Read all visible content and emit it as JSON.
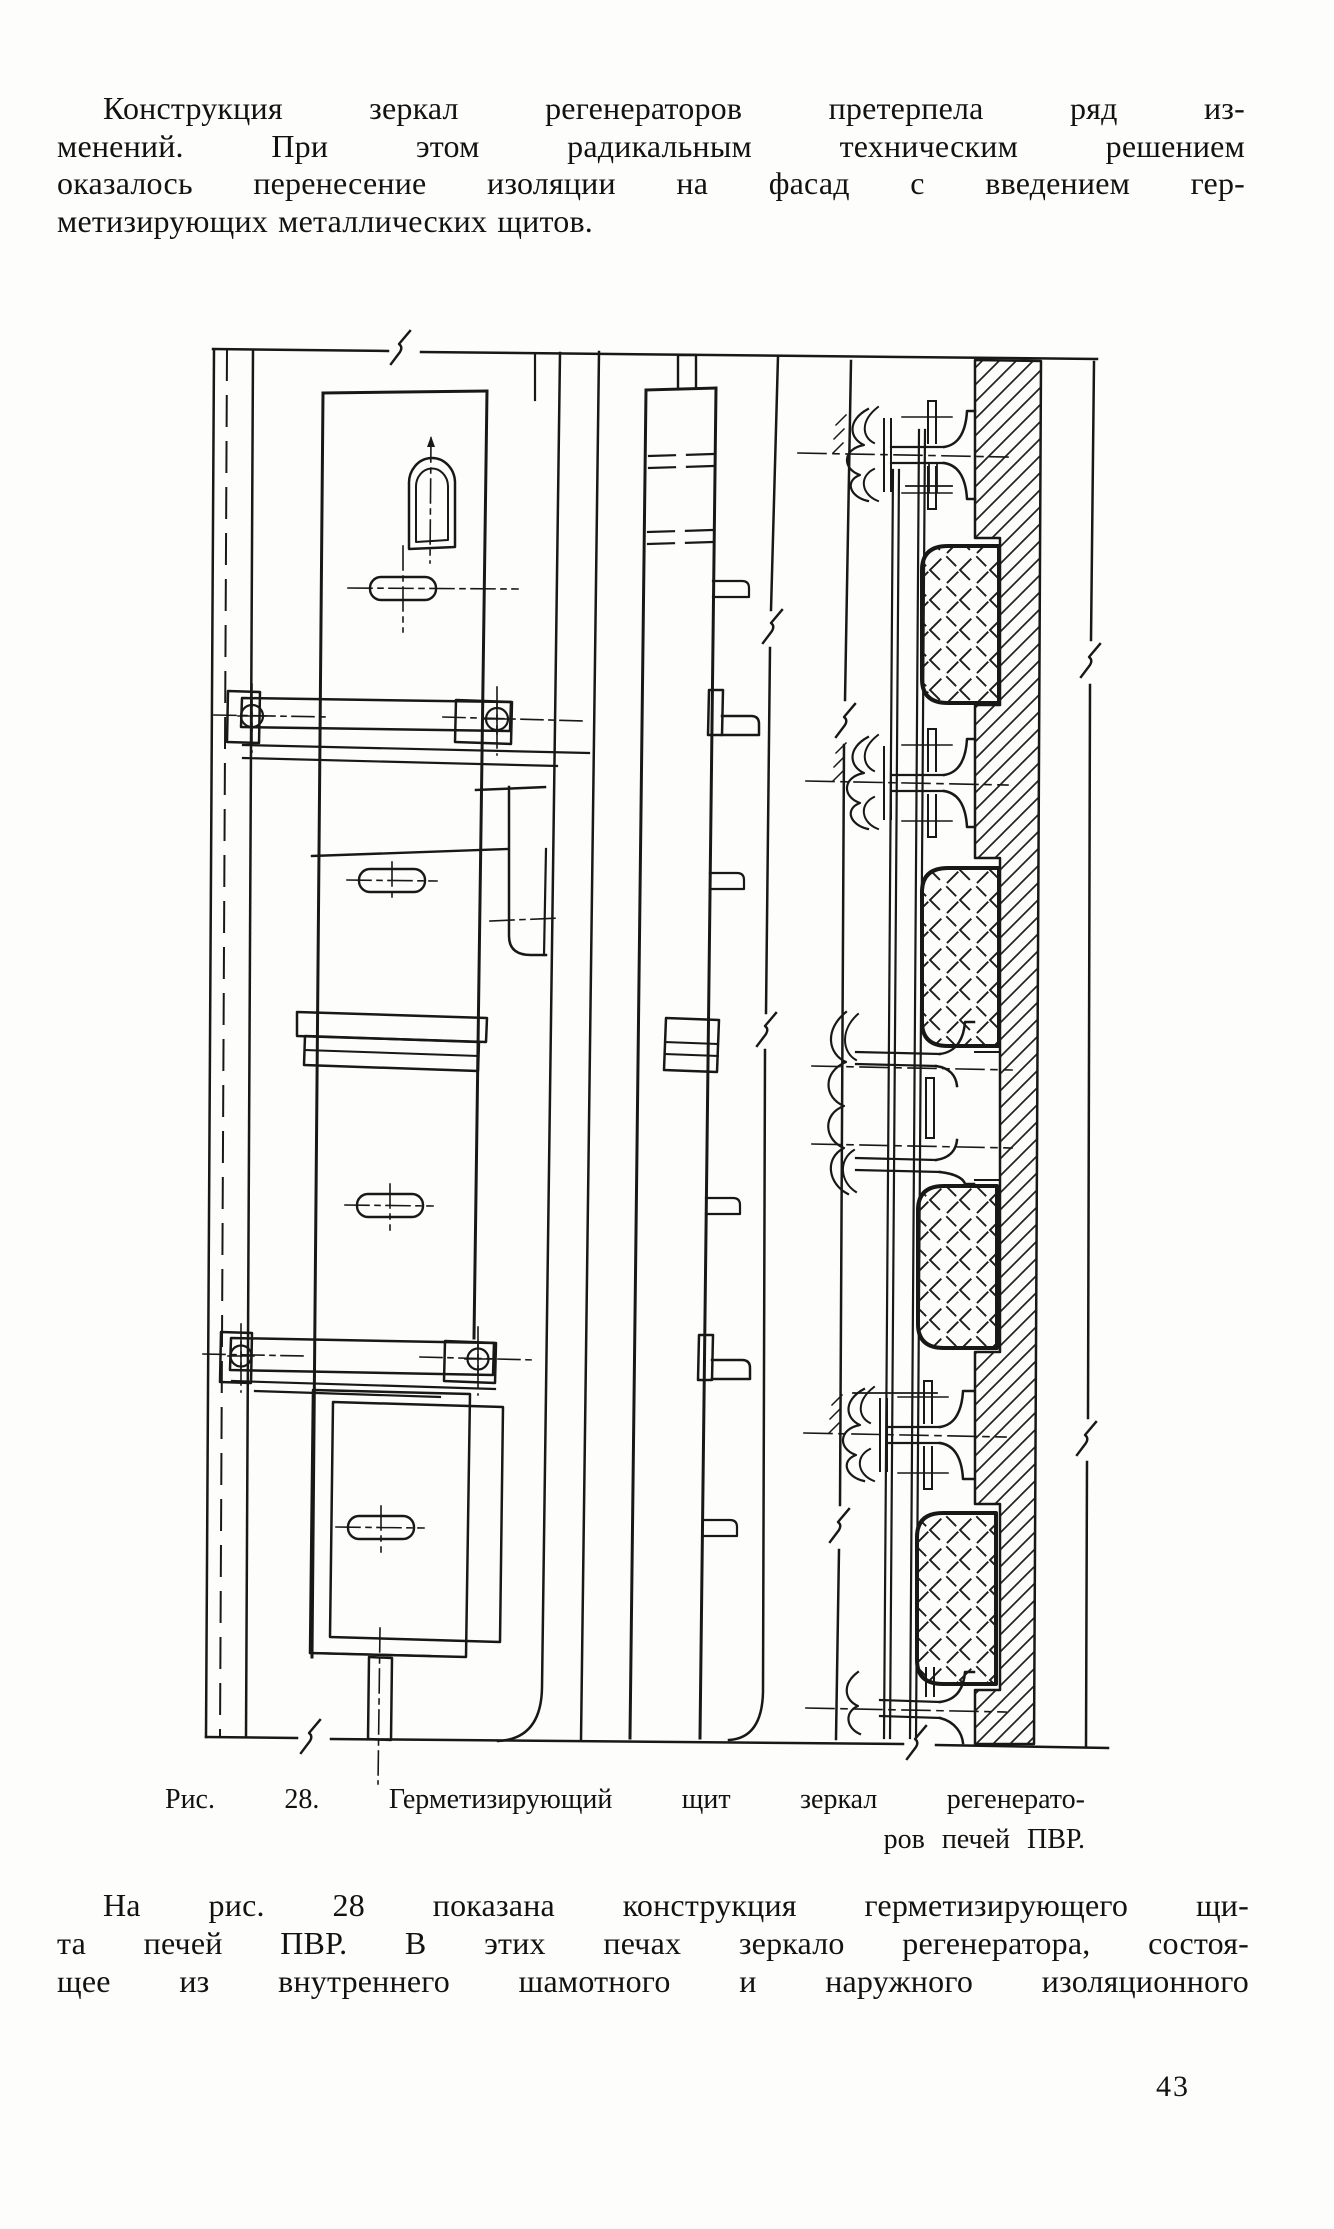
{
  "page": {
    "intro_paragraph": {
      "lines": [
        "Конструкция зеркал регенераторов претерпела ряд из-",
        "менений. При этом радикальным техническим решением",
        "оказалось перенесение изоляции на фасад с введением гер-",
        "метизирующих металлических щитов."
      ]
    },
    "figure_caption": {
      "line1": "Рис. 28. Герметизирующий щит зеркал регенерато-",
      "line2": "ров печей ПВР."
    },
    "body_paragraph": {
      "lines": [
        "На рис. 28 показана конструкция герметизирующего щи-",
        "та печей ПВР. В этих печах зеркало регенератора, состоя-",
        "щее из внутреннего шамотного и наружного изоляционного"
      ]
    },
    "page_number": "43",
    "ink_color": "#181818",
    "paper_color": "#fdfdfb"
  }
}
